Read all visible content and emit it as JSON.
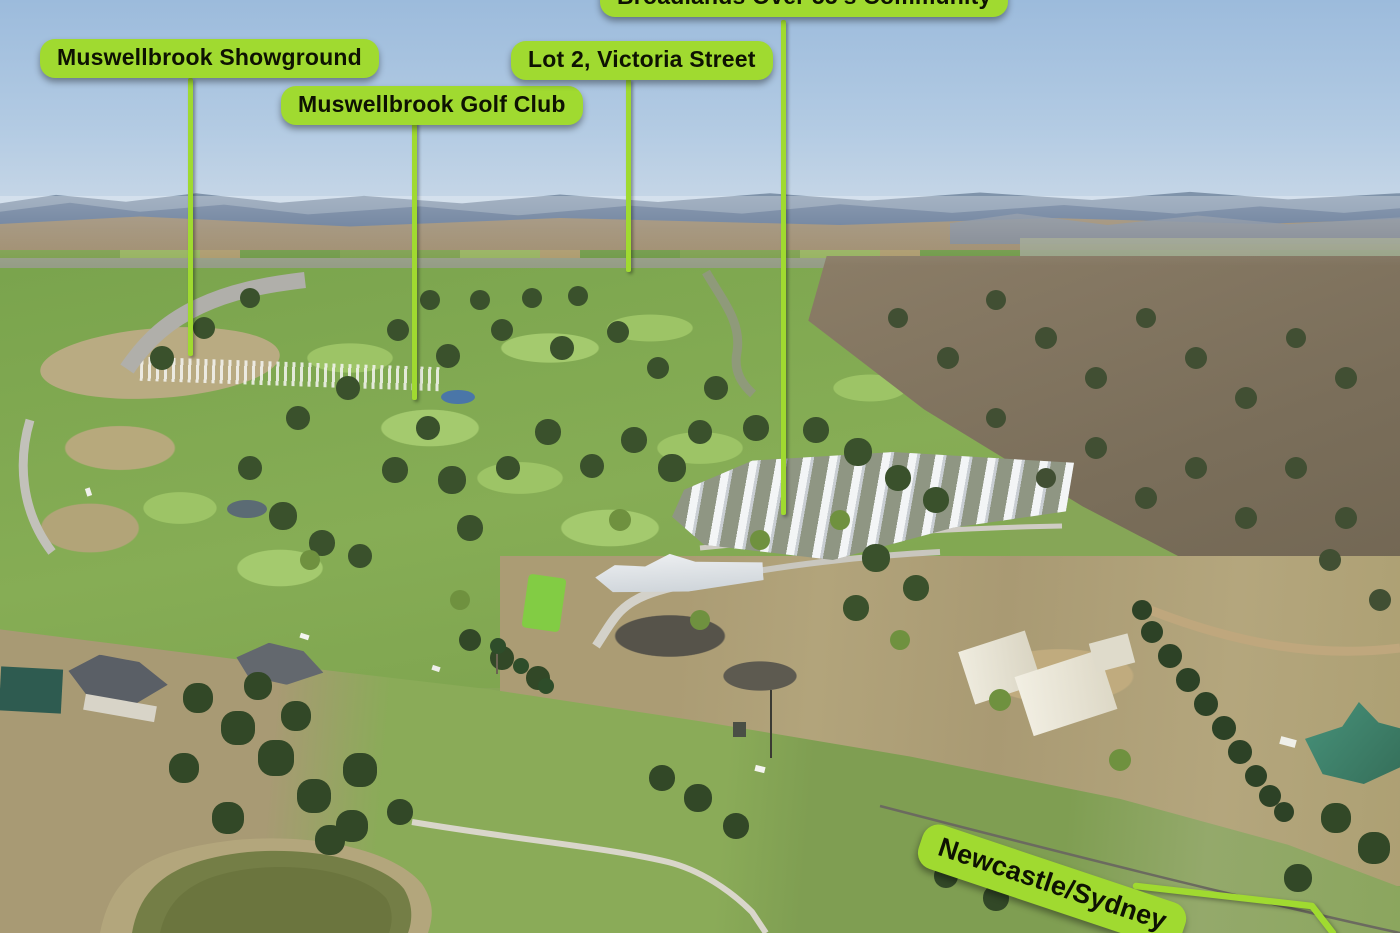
{
  "colors": {
    "label_bg": "#a0da30",
    "label_text": "#0e1202"
  },
  "labels": {
    "showground": "Muswellbrook Showground",
    "golf_club": "Muswellbrook Golf Club",
    "lot2": "Lot 2, Victoria Street",
    "broadlands": "Broadlands Over 55's Community",
    "route": "Newcastle/Sydney"
  }
}
